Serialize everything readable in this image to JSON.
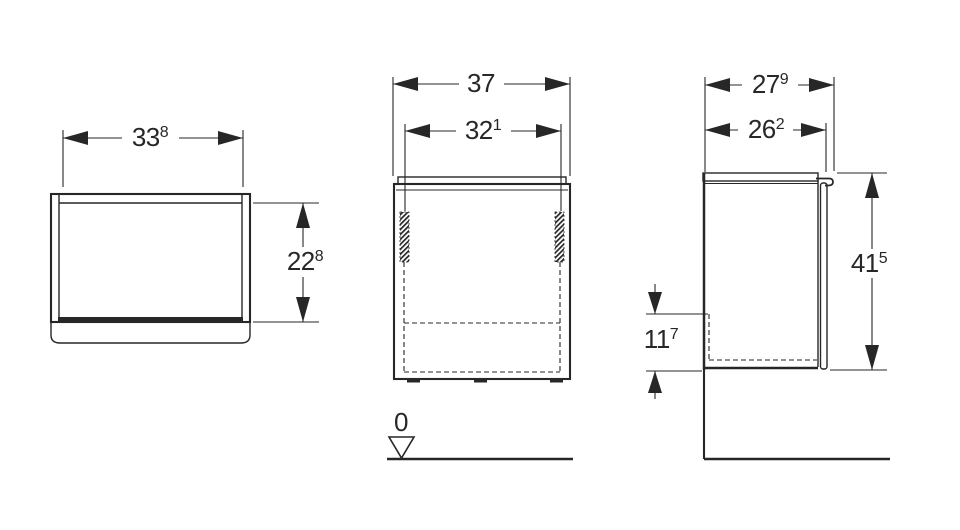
{
  "drawing_title": "cabinet-dimension-drawing",
  "colors": {
    "line": "#272727",
    "background": "#ffffff"
  },
  "views": {
    "front_view": {
      "width": {
        "main": "33",
        "sup": "8"
      },
      "height": {
        "main": "22",
        "sup": "8"
      }
    },
    "center_view": {
      "overall_width": {
        "main": "37",
        "sup": ""
      },
      "inner_width": {
        "main": "32",
        "sup": "1"
      },
      "floor_datum": "0"
    },
    "side_view": {
      "overall_depth": {
        "main": "27",
        "sup": "9"
      },
      "depth_without_handle": {
        "main": "26",
        "sup": "2"
      },
      "height_above_floor": {
        "main": "41",
        "sup": "5"
      },
      "bottom_clearance": {
        "main": "11",
        "sup": "7"
      }
    }
  }
}
